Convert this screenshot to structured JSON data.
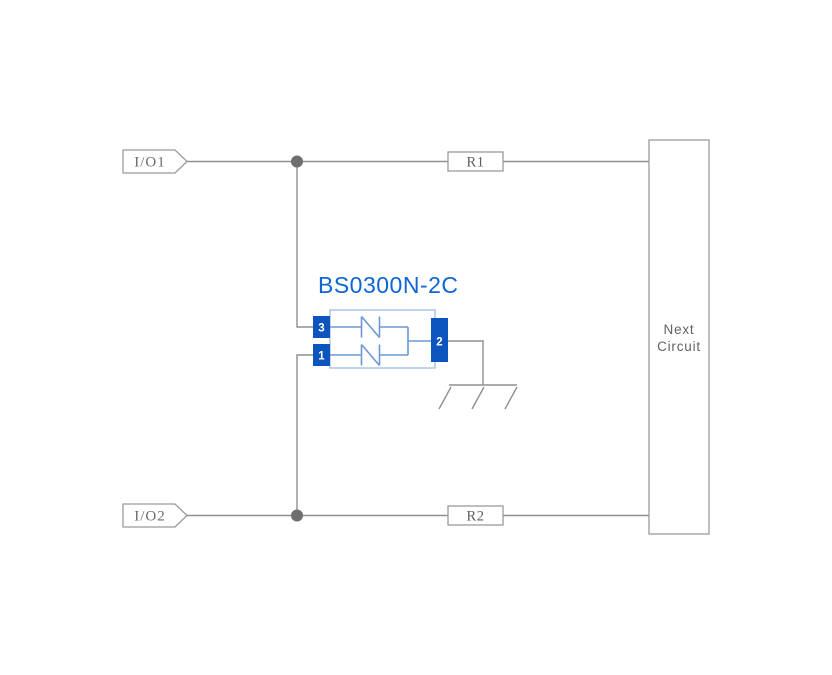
{
  "diagram": {
    "inputs": [
      {
        "label": "I/O1"
      },
      {
        "label": "I/O2"
      }
    ],
    "resistors": [
      {
        "label": "R1"
      },
      {
        "label": "R2"
      }
    ],
    "component": {
      "title": "BS0300N-2C",
      "pins": [
        {
          "number": "1"
        },
        {
          "number": "2"
        },
        {
          "number": "3"
        }
      ]
    },
    "next_circuit": {
      "line1": "Next",
      "line2": "Circuit"
    },
    "colors": {
      "wire_gray": "#8f8f8f",
      "junction_gray": "#6e6e6e",
      "box_stroke_gray": "#9a9a9a",
      "label_gray": "#6b6b6b",
      "pin_blue": "#0d55be",
      "title_blue": "#0e66d6",
      "component_body_blue": "#a5c1e5",
      "diode_blue": "#6c98d4",
      "background": "#ffffff"
    }
  }
}
